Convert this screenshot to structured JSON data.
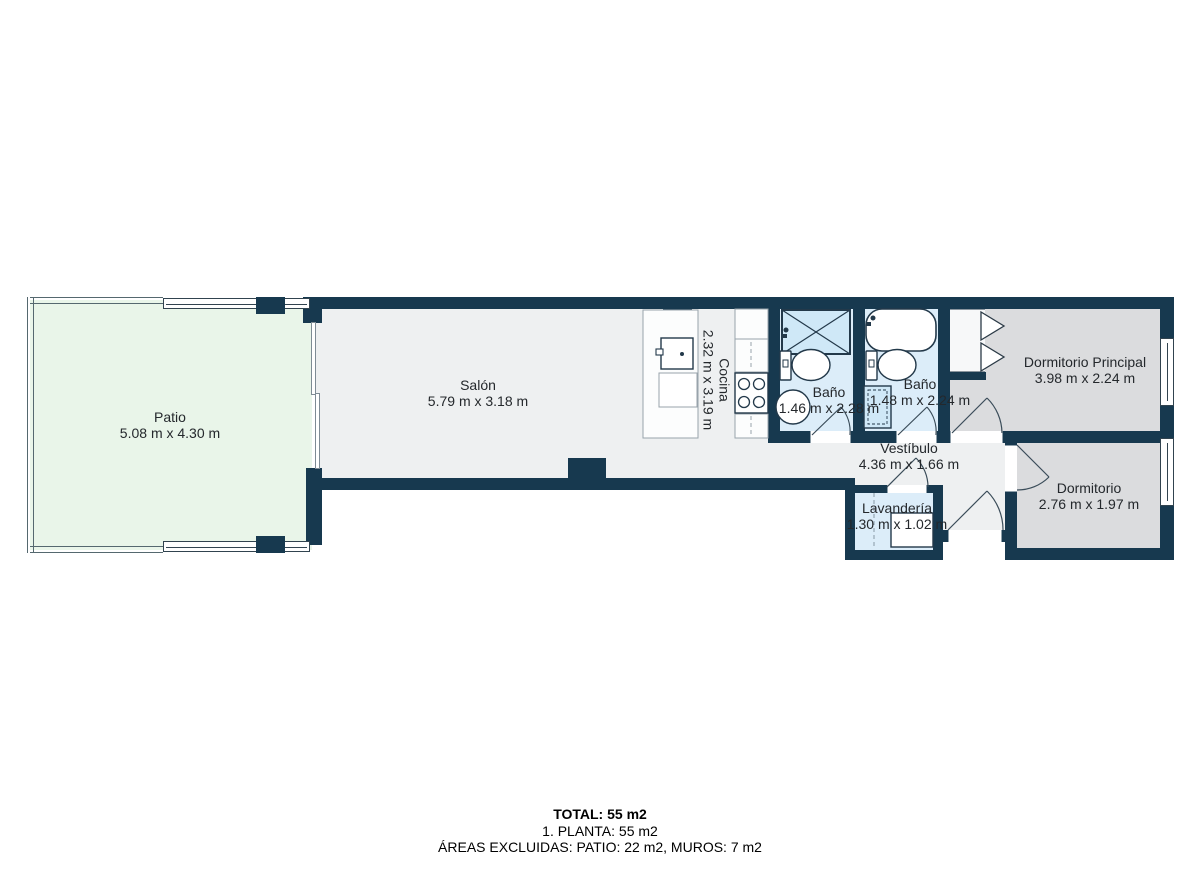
{
  "plan": {
    "rooms": [
      {
        "id": "patio",
        "name": "Patio",
        "dims": "5.08 m x 4.30 m"
      },
      {
        "id": "salon",
        "name": "Salón",
        "dims": "5.79 m x 3.18 m"
      },
      {
        "id": "cocina",
        "name": "Cocina",
        "dims": "2.32 m x 3.19 m"
      },
      {
        "id": "bano-1",
        "name": "Baño",
        "dims": "1.46 m x 2.28 m"
      },
      {
        "id": "bano-2",
        "name": "Baño",
        "dims": "1.48 m x 2.24 m"
      },
      {
        "id": "vestibulo",
        "name": "Vestíbulo",
        "dims": "4.36 m x 1.66 m"
      },
      {
        "id": "lavanderia",
        "name": "Lavandería",
        "dims": "1.30 m x 1.02 m"
      },
      {
        "id": "dormitorio-principal",
        "name": "Dormitorio Principal",
        "dims": "3.98 m x 2.24 m"
      },
      {
        "id": "dormitorio",
        "name": "Dormitorio",
        "dims": "2.76 m x 1.97 m"
      }
    ],
    "colors": {
      "wall": "#17394f",
      "patio_floor": "#e9f5e9",
      "interior_floor": "#eef0f1",
      "bathroom_floor": "#dcedf9",
      "bedroom_floor": "#dbdcde",
      "fixture_blue": "#cfe8f7"
    }
  },
  "footer": {
    "total": "TOTAL: 55 m2",
    "planta": "1. PLANTA: 55 m2",
    "excluidas": "ÁREAS EXCLUIDAS: PATIO: 22 m2, MUROS: 7 m2"
  }
}
